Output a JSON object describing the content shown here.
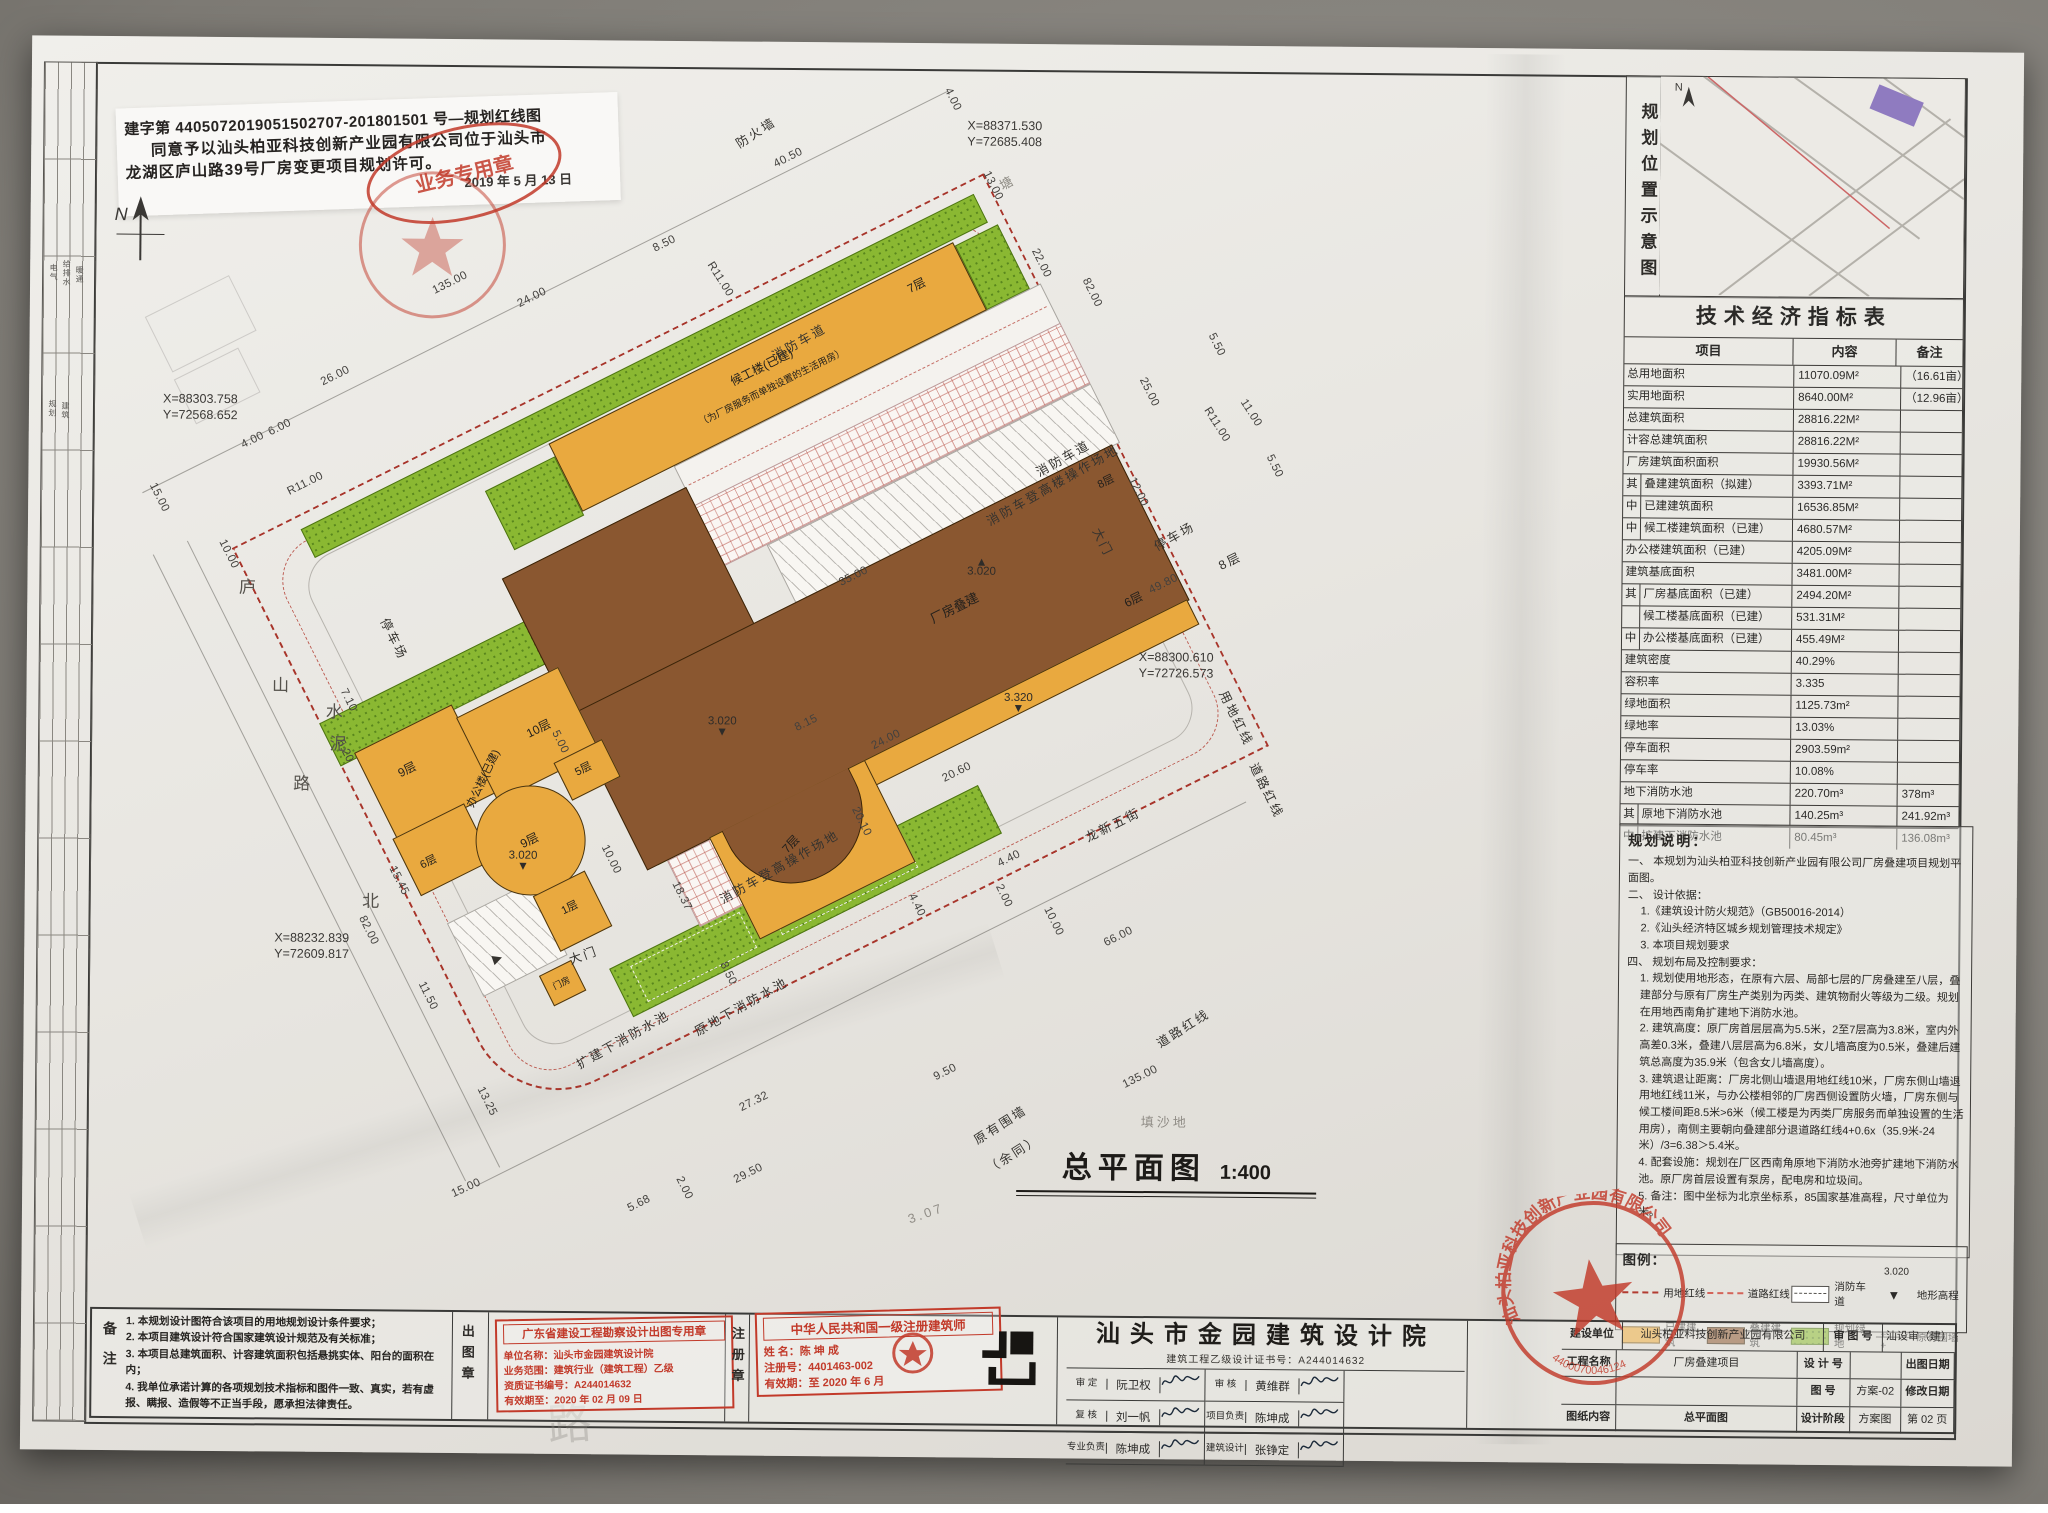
{
  "title": {
    "main": "总平面图",
    "scale": "1:400"
  },
  "permit": {
    "line1": "建字第 4405072019051502707-201801501 号—规划红线图",
    "line2": "同意予以汕头柏亚科技创新产业园有限公司位于汕头市",
    "line3": "龙湖区庐山路39号厂房变更项目规划许可。",
    "date": "2019 年 5 月 13 日",
    "oval_stamp": "业务专用章"
  },
  "north_label": "N",
  "keymap": {
    "title": "规划位置示意图"
  },
  "table": {
    "title": "技术经济指标表",
    "headers": [
      "项目",
      "内容",
      "备注"
    ],
    "rows": [
      {
        "p": "",
        "l": "总用地面积",
        "v": "11070.09M²",
        "n": "（16.61亩）"
      },
      {
        "p": "",
        "l": "实用地面积",
        "v": "8640.00M²",
        "n": "（12.96亩）"
      },
      {
        "p": "",
        "l": "总建筑面积",
        "v": "28816.22M²",
        "n": ""
      },
      {
        "p": "",
        "l": "计容总建筑面积",
        "v": "28816.22M²",
        "n": ""
      },
      {
        "p": "",
        "l": "厂房建筑面积面积",
        "v": "19930.56M²",
        "n": ""
      },
      {
        "p": "其",
        "l": "叠建建筑面积（拟建）",
        "v": "3393.71M²",
        "n": "",
        "i": 1
      },
      {
        "p": "中",
        "l": "已建建筑面积",
        "v": "16536.85M²",
        "n": "",
        "i": 1
      },
      {
        "p": "中",
        "l": "候工楼建筑面积（已建）",
        "v": "4680.57M²",
        "n": "",
        "i": 1
      },
      {
        "p": "",
        "l": "办公楼建筑面积（已建）",
        "v": "4205.09M²",
        "n": ""
      },
      {
        "p": "",
        "l": "建筑基底面积",
        "v": "3481.00M²",
        "n": ""
      },
      {
        "p": "其",
        "l": "厂房基底面积（已建）",
        "v": "2494.20M²",
        "n": "",
        "i": 1
      },
      {
        "p": "",
        "l": "候工楼基底面积（已建）",
        "v": "531.31M²",
        "n": "",
        "i": 1
      },
      {
        "p": "中",
        "l": "办公楼基底面积（已建）",
        "v": "455.49M²",
        "n": "",
        "i": 1
      },
      {
        "p": "",
        "l": "建筑密度",
        "v": "40.29%",
        "n": ""
      },
      {
        "p": "",
        "l": "容积率",
        "v": "3.335",
        "n": ""
      },
      {
        "p": "",
        "l": "绿地面积",
        "v": "1125.73m²",
        "n": ""
      },
      {
        "p": "",
        "l": "绿地率",
        "v": "13.03%",
        "n": ""
      },
      {
        "p": "",
        "l": "停车面积",
        "v": "2903.59m²",
        "n": ""
      },
      {
        "p": "",
        "l": "停车率",
        "v": "10.08%",
        "n": ""
      },
      {
        "p": "",
        "l": "地下消防水池",
        "v": "220.70m³",
        "n": "378m³"
      },
      {
        "p": "其",
        "l": "原地下消防水池",
        "v": "140.25m³",
        "n": "241.92m³",
        "i": 1
      },
      {
        "p": "中",
        "l": "扩建下消防水池",
        "v": "80.45m³",
        "n": "136.08m³",
        "i": 1
      }
    ]
  },
  "notes": {
    "title": "规划说明：",
    "lines": [
      {
        "t": "一、 本规划为汕头柏亚科技创新产业园有限公司厂房叠建项目规划平面图。"
      },
      {
        "t": "二、 设计依据："
      },
      {
        "t": "1.《建筑设计防火规范》（GB50016-2014）",
        "i": 1
      },
      {
        "t": "2.《汕头经济特区城乡规划管理技术规定》",
        "i": 1
      },
      {
        "t": "3. 本项目规划要求",
        "i": 1
      },
      {
        "t": "四、 规划布局及控制要求："
      },
      {
        "t": "1. 规划使用地形态，在原有六层、局部七层的厂房叠建至八层，叠建部分与原有厂房生产类别为丙类、建筑物耐火等级为二级。规划在用地西南角扩建地下消防水池。",
        "i": 1
      },
      {
        "t": "2. 建筑高度：原厂房首层层高为5.5米，2至7层高为3.8米，室内外高差0.3米，叠建八层层高为6.8米，女儿墙高度为0.5米，叠建后建筑总高度为35.9米（包含女儿墙高度）。",
        "i": 1
      },
      {
        "t": "3. 建筑退让距离：厂房北侧山墙退用地红线10米，厂房东侧山墙退用地红线11米，与办公楼相邻的厂房西侧设置防火墙，厂房东侧与候工楼间距8.5米>6米（候工楼是为丙类厂房服务而单独设置的生活用房），南侧主要朝向叠建部分退道路红线4+0.6x（35.9米-24米）/3=6.38＞5.4米。",
        "i": 1
      },
      {
        "t": "4. 配套设施：规划在厂区西南角原地下消防水池旁扩建地下消防水池。原厂房首层设置有泵房，配电房和垃圾间。",
        "i": 1
      },
      {
        "t": "5. 备注：图中坐标为北京坐标系，85国家基准高程，尺寸单位为米。",
        "i": 1
      }
    ]
  },
  "legend": {
    "title": "图例：",
    "items": [
      {
        "sym": "redline1",
        "label": "用地红线"
      },
      {
        "sym": "redline2",
        "label": "道路红线"
      },
      {
        "sym": "lane",
        "label": "消防车道"
      },
      {
        "sym": "elev",
        "label": "地形高程",
        "extra": "3.020",
        "glyph": "▼"
      },
      {
        "sym": "orange",
        "label": "已建建筑"
      },
      {
        "sym": "brown",
        "label": "叠建建筑"
      },
      {
        "sym": "green",
        "label": "规划绿地"
      },
      {
        "sym": "wall",
        "label": "原有围墙"
      }
    ]
  },
  "company_stamp": {
    "text": "汕头柏亚科技创新产业园有限公司",
    "number": "4400070046124"
  },
  "remarks": {
    "side_label": "备注",
    "lines": [
      "1. 本规划设计图符合该项目的用地规划设计条件要求；",
      "2. 本项目建筑设计符合国家建筑设计规范及有关标准；",
      "3. 本项目总建筑面积、计容建筑面积包括悬挑实体、阳台的面积在内；",
      "4. 我单位承诺计算的各项规划技术指标和图件一致、真实，若有虚报、瞒报、造假等不正当手段，愿承担法律责任。"
    ]
  },
  "chutu": {
    "side_label": "出图章",
    "title": "广东省建设工程勘察设计出图专用章",
    "lines": [
      "单位名称：汕头市金园建筑设计院",
      "业务范围：建筑行业（建筑工程）乙级",
      "资质证书编号：A244014632",
      "有效期至：2020 年 02 月 09 日"
    ]
  },
  "zhuce": {
    "side_label": "注册章",
    "title": "中华人民共和国一级注册建筑师",
    "lines": [
      "姓 名：陈 坤 成",
      "注册号：4401463-002",
      "有效期：至 2020 年 6 月"
    ]
  },
  "institute": {
    "name": "汕头市金园建筑设计院",
    "cert": "建筑工程乙级设计证书号：A244014632",
    "sigs": [
      {
        "role": "审 定",
        "name": "阮卫权"
      },
      {
        "role": "审 核",
        "name": "黄维群"
      },
      {
        "role": "复 核",
        "name": "刘一帆"
      },
      {
        "role": "项目负责",
        "name": "陈坤成"
      },
      {
        "role": "专业负责",
        "name": "陈坤成"
      },
      {
        "role": "建筑设计",
        "name": "张铮定"
      }
    ]
  },
  "infoblock": {
    "owner_label": "建设单位",
    "owner": "汕头柏亚科技创新产业园有限公司",
    "project_label": "工程名称",
    "project": "厂房叠建项目",
    "content_label": "图纸内容",
    "content": "总平面图",
    "shen_label": "审 图 号",
    "shen": "汕设审（建）",
    "design_no_label": "设 计 号",
    "design_no": "",
    "date_label": "出图日期",
    "date": "2019-03",
    "fig_label": "图    号",
    "fig": "方案-02",
    "rev_label": "修改日期",
    "rev": "",
    "stage_label": "设计阶段",
    "stage": "方案图",
    "page": "第 02 页",
    "pages": "共 11 页"
  },
  "left_strip": [
    {
      "t": "电气",
      "x": 44,
      "y": 272
    },
    {
      "t": "给排水",
      "x": 57,
      "y": 268
    },
    {
      "t": "暖通",
      "x": 70,
      "y": 274
    },
    {
      "t": "规划",
      "x": 44,
      "y": 408
    },
    {
      "t": "建筑",
      "x": 57,
      "y": 410
    }
  ],
  "plan": {
    "coords": [
      {
        "x": 962,
        "y": 118,
        "l1": "X=88371.530",
        "l2": "Y=72685.408"
      },
      {
        "x": 160,
        "y": 398,
        "l1": "X=88303.758",
        "l2": "Y=72568.652"
      },
      {
        "x": 1138,
        "y": 648,
        "l1": "X=88300.610",
        "l2": "Y=72726.573"
      },
      {
        "x": 276,
        "y": 936,
        "l1": "X=88232.839",
        "l2": "Y=72609.817"
      }
    ],
    "elevations": [
      {
        "v": "3.020",
        "g": "▲",
        "x": 980,
        "y": 568
      },
      {
        "v": "3.020",
        "g": "▼",
        "x": 722,
        "y": 728
      },
      {
        "v": "3.020",
        "g": "▼",
        "x": 524,
        "y": 864
      },
      {
        "v": "3.320",
        "g": "▼",
        "x": 1018,
        "y": 702
      }
    ],
    "annotations": [
      {
        "t": "4.00",
        "x": 947,
        "y": 100,
        "a": 63,
        "c": "dim"
      },
      {
        "t": "40.50",
        "x": 783,
        "y": 160,
        "a": -27,
        "c": "dim"
      },
      {
        "t": "13.00",
        "x": 988,
        "y": 186,
        "a": 63,
        "c": "dim"
      },
      {
        "t": "8.50",
        "x": 660,
        "y": 247,
        "a": -27,
        "c": "dim"
      },
      {
        "t": "24.00",
        "x": 528,
        "y": 302,
        "a": -27,
        "c": "dim"
      },
      {
        "t": "135.00",
        "x": 446,
        "y": 288,
        "a": -27,
        "c": "dim"
      },
      {
        "t": "26.00",
        "x": 332,
        "y": 382,
        "a": -27,
        "c": "dim"
      },
      {
        "t": "R11.00",
        "x": 716,
        "y": 282,
        "a": 57,
        "c": "dim"
      },
      {
        "t": "22.00",
        "x": 1037,
        "y": 263,
        "a": 63,
        "c": "dim"
      },
      {
        "t": "82.00",
        "x": 1088,
        "y": 292,
        "a": 63,
        "c": "dim"
      },
      {
        "t": "R11.00",
        "x": 303,
        "y": 490,
        "a": -27,
        "c": "dim"
      },
      {
        "t": "15.00",
        "x": 157,
        "y": 505,
        "a": 63,
        "c": "dim"
      },
      {
        "t": "25.00",
        "x": 1146,
        "y": 391,
        "a": 63,
        "c": "dim"
      },
      {
        "t": "12.00",
        "x": 1136,
        "y": 491,
        "a": 63,
        "c": "dim"
      },
      {
        "t": "10.00",
        "x": 227,
        "y": 561,
        "a": 63,
        "c": "dim"
      },
      {
        "t": "4.00",
        "x": 250,
        "y": 447,
        "a": -27,
        "c": "dim"
      },
      {
        "t": "6.00",
        "x": 277,
        "y": 434,
        "a": -27,
        "c": "dim"
      },
      {
        "t": "5.50",
        "x": 1213,
        "y": 343,
        "a": 63,
        "c": "dim"
      },
      {
        "t": "5.50",
        "x": 1272,
        "y": 464,
        "a": 63,
        "c": "dim"
      },
      {
        "t": "11.00",
        "x": 1248,
        "y": 411,
        "a": 57,
        "c": "dim"
      },
      {
        "t": "R11.00",
        "x": 1214,
        "y": 423,
        "a": 57,
        "c": "dim"
      },
      {
        "t": "49.80",
        "x": 1162,
        "y": 583,
        "a": -27,
        "c": "dim"
      },
      {
        "t": "35.00",
        "x": 852,
        "y": 578,
        "a": -27,
        "c": "dim"
      },
      {
        "t": "8.15",
        "x": 806,
        "y": 725,
        "a": -27,
        "c": "dim"
      },
      {
        "t": "24.00",
        "x": 886,
        "y": 741,
        "a": -27,
        "c": "dim"
      },
      {
        "t": "20.60",
        "x": 957,
        "y": 773,
        "a": -27,
        "c": "dim"
      },
      {
        "t": "20.10",
        "x": 862,
        "y": 823,
        "a": 63,
        "c": "dim"
      },
      {
        "t": "4.40",
        "x": 918,
        "y": 906,
        "a": 63,
        "c": "dim"
      },
      {
        "t": "4.40",
        "x": 1010,
        "y": 859,
        "a": -27,
        "c": "dim"
      },
      {
        "t": "2.00",
        "x": 1005,
        "y": 896,
        "a": 63,
        "c": "dim"
      },
      {
        "t": "10.00",
        "x": 1055,
        "y": 921,
        "a": 63,
        "c": "dim"
      },
      {
        "t": "66.00",
        "x": 1120,
        "y": 936,
        "a": -27,
        "c": "dim"
      },
      {
        "t": "135.00",
        "x": 1143,
        "y": 1076,
        "a": -27,
        "c": "dim"
      },
      {
        "t": "9.50",
        "x": 948,
        "y": 1073,
        "a": -27,
        "c": "dim"
      },
      {
        "t": "27.32",
        "x": 757,
        "y": 1104,
        "a": -27,
        "c": "dim"
      },
      {
        "t": "29.50",
        "x": 752,
        "y": 1176,
        "a": -27,
        "c": "dim"
      },
      {
        "t": "5.68",
        "x": 643,
        "y": 1207,
        "a": -27,
        "c": "dim"
      },
      {
        "t": "2.00",
        "x": 688,
        "y": 1191,
        "a": 63,
        "c": "dim"
      },
      {
        "t": "13.25",
        "x": 490,
        "y": 1106,
        "a": 63,
        "c": "dim"
      },
      {
        "t": "11.50",
        "x": 430,
        "y": 1001,
        "a": 63,
        "c": "dim"
      },
      {
        "t": "82.00",
        "x": 370,
        "y": 936,
        "a": 63,
        "c": "dim"
      },
      {
        "t": "15.45",
        "x": 400,
        "y": 886,
        "a": 63,
        "c": "dim"
      },
      {
        "t": "18.37",
        "x": 683,
        "y": 899,
        "a": 63,
        "c": "dim"
      },
      {
        "t": "10.00",
        "x": 612,
        "y": 863,
        "a": 63,
        "c": "dim"
      },
      {
        "t": "8.50",
        "x": 730,
        "y": 976,
        "a": 63,
        "c": "dim"
      },
      {
        "t": "7.10",
        "x": 348,
        "y": 706,
        "a": 63,
        "c": "dim"
      },
      {
        "t": "5.20",
        "x": 345,
        "y": 757,
        "a": 63,
        "c": "dim"
      },
      {
        "t": "5.00",
        "x": 560,
        "y": 746,
        "a": 63,
        "c": "dim"
      },
      {
        "t": "15.00",
        "x": 470,
        "y": 1193,
        "a": -25,
        "c": "dim"
      },
      {
        "t": "防火墙",
        "x": 750,
        "y": 134,
        "a": -33,
        "c": "lbl"
      },
      {
        "t": "塘",
        "x": 1002,
        "y": 182,
        "a": -30,
        "c": "faint"
      },
      {
        "t": "消防车道",
        "x": 795,
        "y": 343,
        "a": -30,
        "c": "lbl"
      },
      {
        "t": "消防车道",
        "x": 1060,
        "y": 457,
        "a": -30,
        "c": "lbl"
      },
      {
        "t": "消防车登高楼操作场地",
        "x": 1050,
        "y": 484,
        "a": -30,
        "c": "lbl"
      },
      {
        "t": "停车场",
        "x": 1172,
        "y": 534,
        "a": -30,
        "c": "lbl"
      },
      {
        "t": "8层",
        "x": 1228,
        "y": 558,
        "a": -27,
        "c": "lbl"
      },
      {
        "t": "大门",
        "x": 1102,
        "y": 541,
        "a": 63,
        "c": "lbl"
      },
      {
        "t": "用地红线",
        "x": 1237,
        "y": 716,
        "a": 63,
        "c": "lbl"
      },
      {
        "t": "道路红线",
        "x": 1268,
        "y": 788,
        "a": 63,
        "c": "lbl"
      },
      {
        "t": "龙新五街",
        "x": 1113,
        "y": 823,
        "a": -27,
        "c": "lbl"
      },
      {
        "t": "道路红线",
        "x": 1185,
        "y": 1026,
        "a": -33,
        "c": "lbl"
      },
      {
        "t": "原有围墙",
        "x": 1003,
        "y": 1124,
        "a": -33,
        "c": "lbl"
      },
      {
        "t": "（余同）",
        "x": 1016,
        "y": 1153,
        "a": -33,
        "c": "lbl"
      },
      {
        "t": "填沙地",
        "x": 1168,
        "y": 1120,
        "a": 0,
        "c": "faint"
      },
      {
        "t": "停车场",
        "x": 394,
        "y": 644,
        "a": 63,
        "c": "lbl"
      },
      {
        "t": "消防车登高操作场地",
        "x": 780,
        "y": 868,
        "a": -30,
        "c": "lbl"
      },
      {
        "t": "原地下消防水池",
        "x": 743,
        "y": 1008,
        "a": -30,
        "c": "lbl"
      },
      {
        "t": "扩建下消防水池",
        "x": 625,
        "y": 1042,
        "a": -30,
        "c": "lbl"
      },
      {
        "t": "大门",
        "x": 585,
        "y": 958,
        "a": -20,
        "c": "lbl"
      },
      {
        "t": "▶",
        "x": 500,
        "y": 962,
        "a": -20,
        "c": "lbl"
      },
      {
        "t": "3.07",
        "x": 930,
        "y": 1214,
        "a": -20,
        "c": "faint"
      },
      {
        "t": "庐",
        "x": 246,
        "y": 592,
        "a": 0,
        "c": "road"
      },
      {
        "t": "山",
        "x": 280,
        "y": 690,
        "a": 0,
        "c": "road"
      },
      {
        "t": "路",
        "x": 302,
        "y": 788,
        "a": 0,
        "c": "road"
      },
      {
        "t": "水",
        "x": 334,
        "y": 716,
        "a": 0,
        "c": "road"
      },
      {
        "t": "泥",
        "x": 338,
        "y": 748,
        "a": 0,
        "c": "road"
      },
      {
        "t": "北",
        "x": 372,
        "y": 905,
        "a": 0,
        "c": "road"
      },
      {
        "t": "路",
        "x": 575,
        "y": 1424,
        "a": -5,
        "c": "ghost"
      }
    ],
    "site_labels": [
      {
        "t": "候工楼(已建)",
        "x": 555,
        "y": 74,
        "s": 12
      },
      {
        "t": "（为厂房服务而单独设置的生活用房）",
        "x": 555,
        "y": 96,
        "s": 9.5
      },
      {
        "t": "7层",
        "x": 730,
        "y": 70,
        "s": 12
      },
      {
        "t": "厂房叠建",
        "x": 620,
        "y": 375,
        "s": 13
      },
      {
        "t": "6层",
        "x": 784,
        "y": 448,
        "s": 12
      },
      {
        "t": "8层",
        "x": 812,
        "y": 330,
        "s": 11
      },
      {
        "t": "7层",
        "x": 368,
        "y": 514,
        "s": 12,
        "a": -20
      },
      {
        "t": "办公楼(已建)",
        "x": 122,
        "y": 318,
        "s": 11,
        "a": -38
      },
      {
        "t": "9层",
        "x": 58,
        "y": 276,
        "s": 12
      },
      {
        "t": "10层",
        "x": 194,
        "y": 298,
        "s": 12
      },
      {
        "t": "5层",
        "x": 216,
        "y": 354,
        "s": 11
      },
      {
        "t": "6层",
        "x": 36,
        "y": 368,
        "s": 11
      },
      {
        "t": "9层",
        "x": 136,
        "y": 394,
        "s": 12
      },
      {
        "t": "1层",
        "x": 142,
        "y": 472,
        "s": 11
      },
      {
        "t": "门房",
        "x": 101,
        "y": 536,
        "s": 9
      }
    ]
  }
}
